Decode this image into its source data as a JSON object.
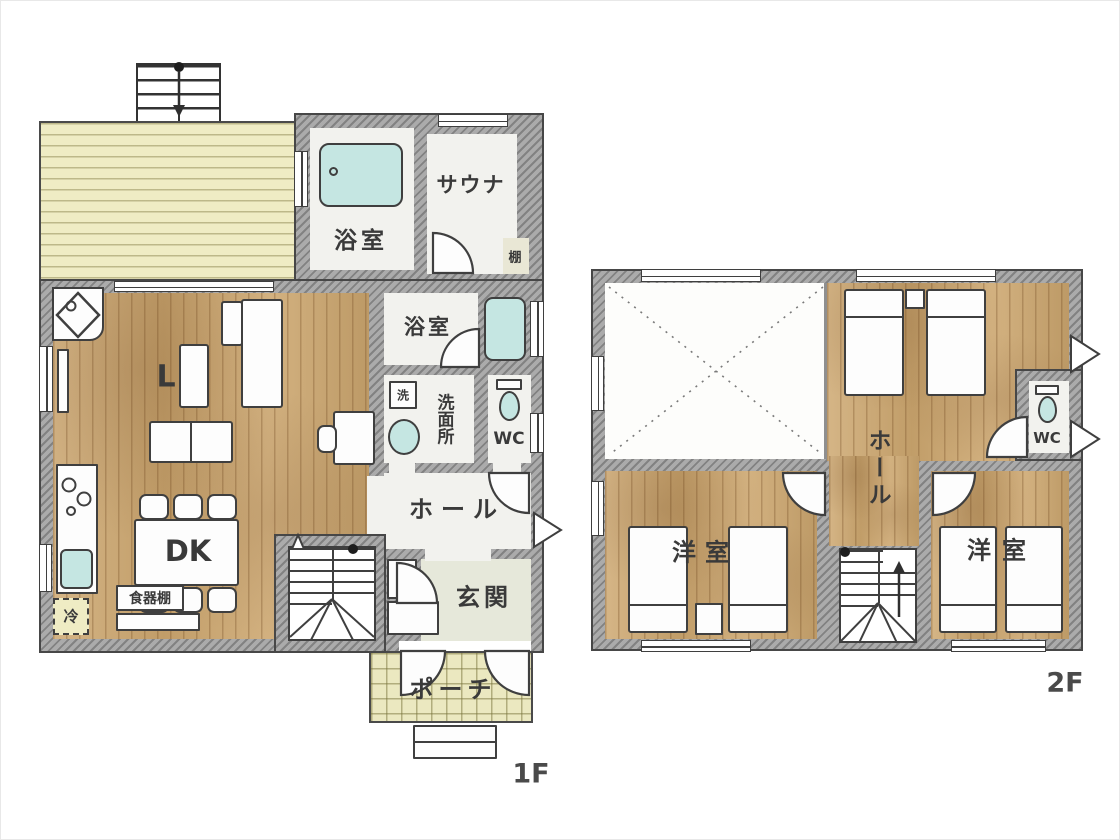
{
  "colors": {
    "wall": "#9b9b9b",
    "wood_floor": "#cda76f",
    "deck": "#efecc4",
    "porch_tile": "#ebe8c0",
    "fixture_teal": "#c5e6e2",
    "outline": "#3f3f3f",
    "entrance_floor": "#e6e8da"
  },
  "floor1": {
    "label": "1F",
    "rooms": {
      "bath_top": "浴室",
      "sauna": "サウナ",
      "shelf": "棚",
      "bath_mid": "浴室",
      "laundry": "洗",
      "washroom": "洗面所",
      "wc": "WC",
      "hall": "ホール",
      "entrance": "玄関",
      "porch": "ポーチ",
      "living": "L",
      "dining_kitchen": "DK",
      "fridge": "冷",
      "cupboard": "食器棚"
    }
  },
  "floor2": {
    "label": "2F",
    "rooms": {
      "hall": "ホール",
      "wc": "WC",
      "bedroom_left": "洋室",
      "bedroom_right": "洋室"
    }
  }
}
